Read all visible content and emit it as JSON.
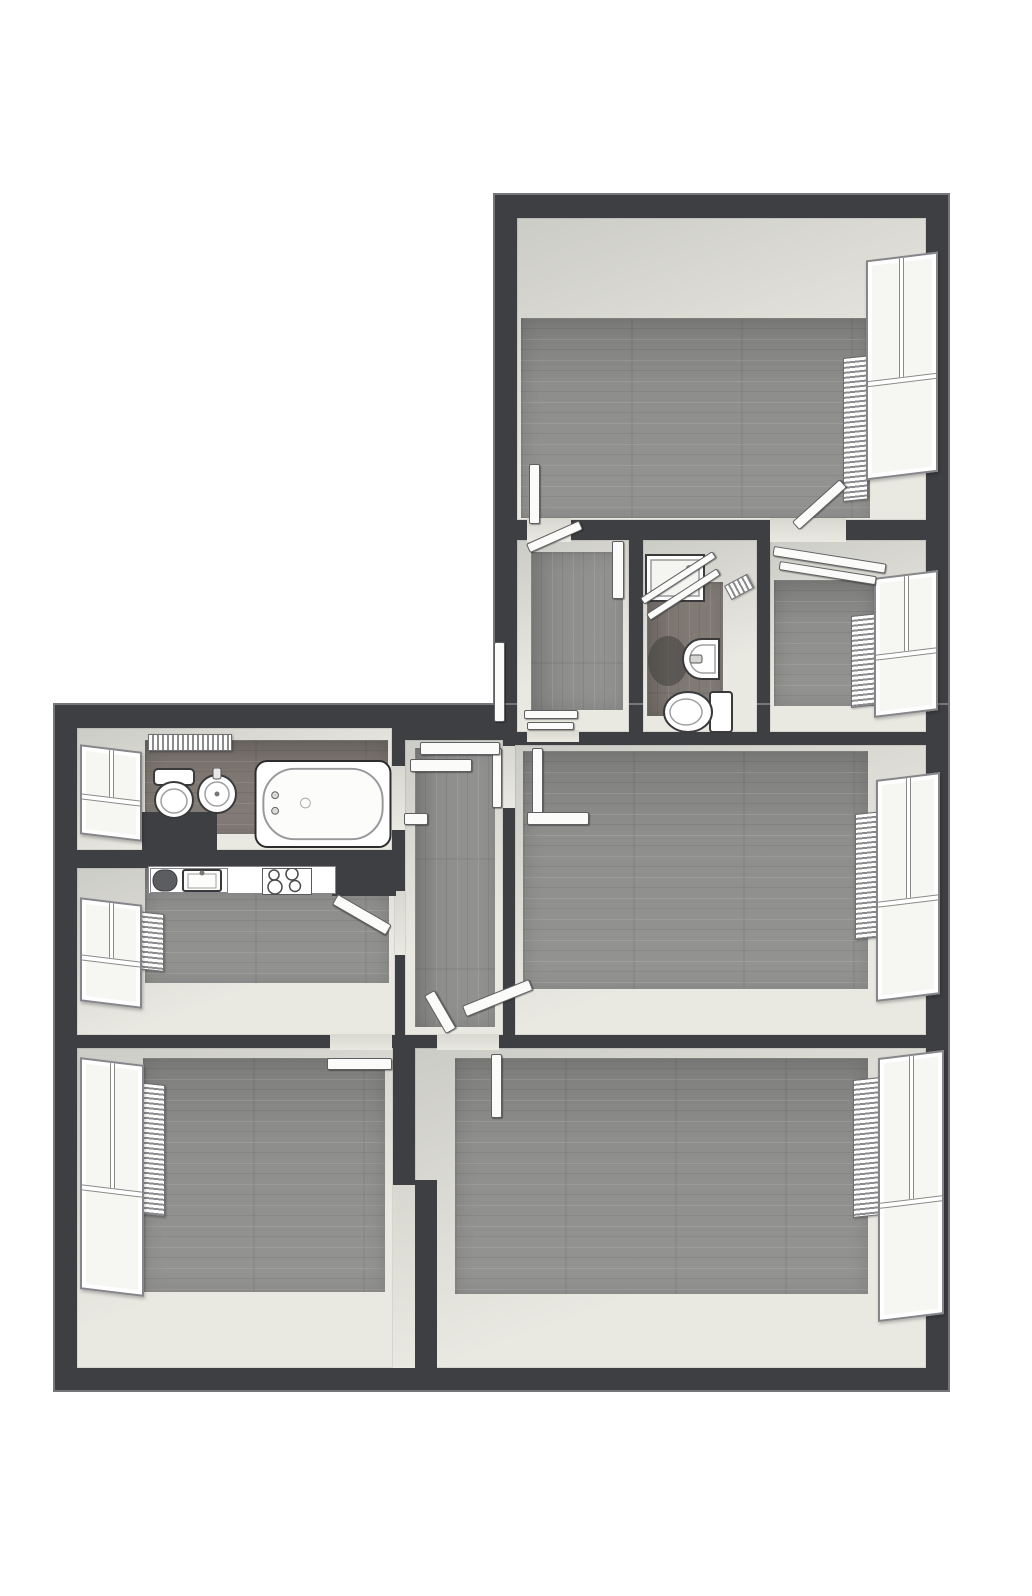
{
  "title": "3D rendered apartment floor plan, top-down view, no text labels",
  "plan": {
    "canvas": {
      "w": 1032,
      "h": 1596
    },
    "colors": {
      "bg": "#ffffff",
      "wall": "#3e3f42",
      "wallEdge": "#75767a",
      "floor": "#8e8e8c",
      "floorDark": "#7d7671",
      "face1": "#ccccc6",
      "face2": "#e9e8e1",
      "glass": "#f6f6f3",
      "fixtureLine": "#3a3a3c",
      "fixtureWhite": "#ffffff"
    },
    "slabs": [
      {
        "id": "upper-wing-walls",
        "rect": [
          495,
          195,
          453,
          555
        ]
      },
      {
        "id": "lower-wing-walls",
        "rect": [
          55,
          705,
          893,
          685
        ]
      }
    ],
    "rooms": [
      {
        "id": "bedroom-top",
        "rect": [
          517,
          218,
          409,
          302
        ],
        "bands": [
          100,
          56,
          2,
          4
        ],
        "floor": "wood",
        "plank": "h"
      },
      {
        "id": "entry-room",
        "rect": [
          517,
          540,
          112,
          192
        ],
        "bands": [
          12,
          6,
          22,
          14
        ],
        "floor": "wood",
        "plank": "v"
      },
      {
        "id": "bathroom-small",
        "rect": [
          643,
          540,
          114,
          192
        ],
        "bands": [
          42,
          34,
          16,
          4
        ],
        "floor": "wood-dark",
        "plank": "v"
      },
      {
        "id": "room-top-right",
        "rect": [
          770,
          540,
          156,
          192
        ],
        "bands": [
          40,
          52,
          26,
          4
        ],
        "floor": "wood",
        "plank": "h"
      },
      {
        "id": "bathroom-left",
        "rect": [
          77,
          728,
          315,
          122
        ],
        "bands": [
          12,
          4,
          16,
          68
        ],
        "floor": "wood-dark",
        "plank": "h"
      },
      {
        "id": "kitchen",
        "rect": [
          77,
          868,
          318,
          167
        ],
        "bands": [
          0,
          6,
          52,
          68
        ],
        "floor": "wood",
        "plank": "h"
      },
      {
        "id": "hallway",
        "rect": [
          405,
          740,
          98,
          295
        ],
        "bands": [
          8,
          8,
          8,
          10
        ],
        "floor": "wood",
        "plank": "v"
      },
      {
        "id": "living-room",
        "rect": [
          515,
          745,
          411,
          290
        ],
        "bands": [
          6,
          58,
          46,
          8
        ],
        "floor": "wood",
        "plank": "h"
      },
      {
        "id": "bedroom-left",
        "rect": [
          77,
          1048,
          316,
          320
        ],
        "bands": [
          10,
          8,
          76,
          66
        ],
        "floor": "wood",
        "plank": "h"
      },
      {
        "id": "bedroom-right",
        "rect": [
          415,
          1048,
          511,
          320
        ],
        "bands": [
          10,
          58,
          74,
          40
        ],
        "floor": "wood",
        "plank": "h"
      }
    ],
    "openings": [
      {
        "id": "door-opening-bedroom-top-left",
        "rect": [
          527,
          518,
          44,
          24
        ]
      },
      {
        "id": "door-opening-bedroom-top-right",
        "rect": [
          770,
          518,
          76,
          24
        ]
      },
      {
        "id": "door-opening-entry-hall",
        "rect": [
          527,
          730,
          52,
          12
        ]
      },
      {
        "id": "door-opening-hall-living",
        "rect": [
          503,
          746,
          12,
          62
        ]
      },
      {
        "id": "door-opening-hall-bathroom",
        "rect": [
          392,
          766,
          13,
          64
        ]
      },
      {
        "id": "door-opening-hall-kitchen",
        "rect": [
          395,
          891,
          10,
          64
        ]
      },
      {
        "id": "door-opening-bedroom-left",
        "rect": [
          330,
          1034,
          62,
          16
        ]
      },
      {
        "id": "door-opening-bedroom-right",
        "rect": [
          437,
          1034,
          62,
          16
        ]
      },
      {
        "id": "wall-recess-bedrooms",
        "rect": [
          393,
          1185,
          22,
          183
        ]
      }
    ],
    "windows": [
      {
        "id": "window-bedroom-top",
        "rect": [
          866,
          256,
          72,
          220
        ],
        "side": "right"
      },
      {
        "id": "window-room-top-right",
        "rect": [
          874,
          574,
          64,
          140
        ],
        "side": "right"
      },
      {
        "id": "window-living-room",
        "rect": [
          876,
          776,
          64,
          222
        ],
        "side": "right"
      },
      {
        "id": "window-bedroom-right",
        "rect": [
          878,
          1054,
          66,
          264
        ],
        "side": "right"
      },
      {
        "id": "window-bathroom-left",
        "rect": [
          80,
          748,
          62,
          90
        ],
        "side": "left"
      },
      {
        "id": "window-kitchen",
        "rect": [
          80,
          901,
          62,
          104
        ],
        "side": "left"
      },
      {
        "id": "window-bedroom-left",
        "rect": [
          80,
          1061,
          64,
          232
        ],
        "side": "left"
      }
    ],
    "radiators": [
      {
        "id": "radiator-bedroom-top",
        "rect": [
          843,
          358,
          25,
          144
        ],
        "orient": "v",
        "side": "right"
      },
      {
        "id": "radiator-room-top-right",
        "rect": [
          851,
          616,
          26,
          92
        ],
        "orient": "v",
        "side": "right"
      },
      {
        "id": "radiator-living-room",
        "rect": [
          855,
          814,
          26,
          126
        ],
        "orient": "v",
        "side": "right"
      },
      {
        "id": "radiator-bedroom-right",
        "rect": [
          853,
          1080,
          27,
          138
        ],
        "orient": "v",
        "side": "right"
      },
      {
        "id": "radiator-bedroom-left",
        "rect": [
          137,
          1082,
          28,
          132
        ],
        "orient": "v",
        "side": "left"
      },
      {
        "id": "radiator-kitchen",
        "rect": [
          136,
          911,
          28,
          58
        ],
        "orient": "v",
        "side": "left"
      },
      {
        "id": "towel-radiator-bathroom-left",
        "rect": [
          148,
          734,
          84,
          17
        ],
        "orient": "h",
        "rot": 0
      },
      {
        "id": "towel-radiator-bathroom-small",
        "rect": [
          724,
          586,
          26,
          16
        ],
        "orient": "h",
        "rot": -28
      }
    ],
    "doors": [
      {
        "id": "door-leaf-bedroom-top-left",
        "rect": [
          529,
          464,
          11,
          60
        ],
        "rot": 0
      },
      {
        "id": "door-leaf-bedroom-top-right",
        "rect": [
          792,
          522,
          64,
          11
        ],
        "rot": -42
      },
      {
        "id": "entry-door",
        "rect": [
          494,
          642,
          11,
          80
        ],
        "rot": 0
      },
      {
        "id": "door-leaf-living-room",
        "rect": [
          532,
          748,
          11,
          70
        ],
        "rot": 0
      },
      {
        "id": "door-leaf-living-room-2",
        "rect": [
          527,
          812,
          62,
          13
        ],
        "rot": 0
      },
      {
        "id": "door-leaf-hallway-right",
        "rect": [
          492,
          748,
          10,
          60
        ],
        "rot": 0
      },
      {
        "id": "hallway-shelf-1",
        "rect": [
          420,
          742,
          80,
          13
        ],
        "rot": 0
      },
      {
        "id": "hallway-shelf-2",
        "rect": [
          410,
          759,
          62,
          13
        ],
        "rot": 0
      },
      {
        "id": "hallway-ledge",
        "rect": [
          404,
          813,
          24,
          12
        ],
        "rot": 0
      },
      {
        "id": "door-leaf-kitchen",
        "rect": [
          338,
          894,
          62,
          12
        ],
        "rot": 30
      },
      {
        "id": "door-leaf-hallway-bottom-1",
        "rect": [
          424,
          996,
          12,
          44
        ],
        "rot": -30
      },
      {
        "id": "door-leaf-hallway-bottom-2",
        "rect": [
          462,
          1006,
          72,
          12
        ],
        "rot": -22
      },
      {
        "id": "door-leaf-bedroom-left",
        "rect": [
          327,
          1058,
          65,
          12
        ],
        "rot": 0
      },
      {
        "id": "door-leaf-bedroom-right",
        "rect": [
          491,
          1054,
          11,
          64
        ],
        "rot": 0
      },
      {
        "id": "entry-threshold-1",
        "rect": [
          524,
          710,
          54,
          9
        ],
        "rot": 0
      },
      {
        "id": "entry-threshold-2",
        "rect": [
          527,
          722,
          47,
          8
        ],
        "rot": 0
      },
      {
        "id": "closet-rail-room-top-right-1",
        "rect": [
          774,
          546,
          114,
          10
        ],
        "rot": 9
      },
      {
        "id": "closet-rail-room-top-right-2",
        "rect": [
          780,
          561,
          98,
          9
        ],
        "rot": 9
      },
      {
        "id": "closet-rail-entry",
        "rect": [
          526,
          544,
          58,
          10
        ],
        "rot": -24
      },
      {
        "id": "closet-rail-entry-vertical",
        "rect": [
          612,
          541,
          12,
          58
        ],
        "rot": 0
      }
    ],
    "fixtures": [
      {
        "type": "block",
        "id": "wall-jog-bedrooms",
        "rect": [
          415,
          1180,
          22,
          188
        ]
      },
      {
        "type": "block",
        "id": "duct-block-bathroom",
        "rect": [
          142,
          812,
          75,
          44
        ]
      },
      {
        "type": "block",
        "id": "wall-stub-kitchen",
        "rect": [
          332,
          860,
          64,
          36
        ]
      },
      {
        "type": "bathtub",
        "id": "bathtub",
        "rect": [
          254,
          760,
          138,
          88
        ]
      },
      {
        "type": "toilet-up",
        "id": "toilet-bathroom-left",
        "rect": [
          151,
          768,
          46,
          52
        ]
      },
      {
        "type": "sink-round",
        "id": "wash-basin-left",
        "rect": [
          196,
          768,
          42,
          48
        ]
      },
      {
        "type": "counter",
        "id": "kitchen-counter",
        "rect": [
          148,
          866,
          188,
          28
        ]
      },
      {
        "type": "kitchen-sink",
        "id": "kitchen-sink",
        "rect": [
          150,
          868,
          78,
          25
        ]
      },
      {
        "type": "cooktop",
        "id": "cooktop",
        "rect": [
          262,
          868,
          50,
          27
        ]
      },
      {
        "type": "shower",
        "id": "shower-tray",
        "rect": [
          645,
          554,
          60,
          48
        ]
      },
      {
        "type": "glass-bar",
        "id": "shower-glass-1",
        "rect": [
          640,
          598,
          86,
          8
        ],
        "rot": -33
      },
      {
        "type": "glass-bar",
        "id": "shower-glass-2",
        "rect": [
          646,
          614,
          84,
          8
        ],
        "rot": -33
      },
      {
        "type": "shadow",
        "id": "sink-shadow",
        "rect": [
          648,
          636,
          40,
          50
        ]
      },
      {
        "type": "sink-d",
        "id": "wash-basin-small",
        "rect": [
          682,
          638,
          38,
          42
        ]
      },
      {
        "type": "toilet-right",
        "id": "toilet-bathroom-small",
        "rect": [
          662,
          690,
          72,
          44
        ]
      }
    ]
  }
}
